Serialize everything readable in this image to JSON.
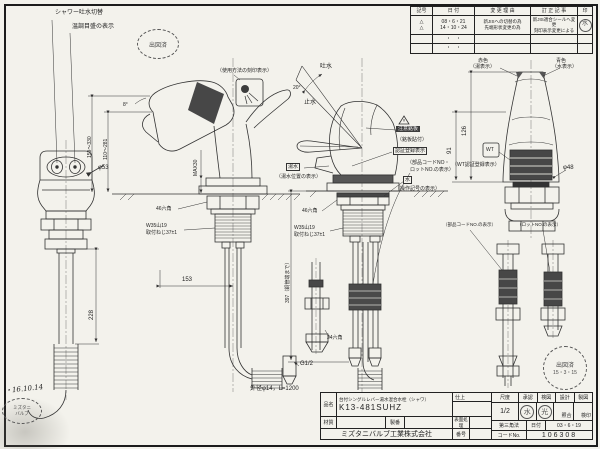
{
  "frame": {
    "paper": "#f3f2ec",
    "line": "#2b2b2b",
    "dark_fill": "#474747"
  },
  "revision": {
    "headers": [
      "記号",
      "日 付",
      "変 更 理 由",
      "訂 正 記 事",
      "印"
    ],
    "row1": {
      "sym1": "△",
      "sym2": "△",
      "date1": "08・6・21",
      "date2": "14・10・24",
      "reason1": "新JISへの切替の為",
      "reason2": "先端形状変更の為",
      "corr1": "新JIS適合シールへ変更",
      "corr2": "刻印表示変更による",
      "stamp": "水"
    },
    "row2_dots": "・　・",
    "row3_dots": "・　・"
  },
  "title_block": {
    "item_label": "品名",
    "item_name": "台付シングルレバー湯水混合水栓（シャワ）",
    "part_no": "K13-481SUHZ",
    "material_label": "材質",
    "material": "",
    "seiban_label": "製番",
    "seiban": "",
    "finish_label": "仕上",
    "finish": "",
    "surface_label": "表面処理",
    "surface": "",
    "bango_label": "番号",
    "bango": "",
    "company": "ミズタニバルブ工業株式会社",
    "scale_label": "尺度",
    "scale": "1/2",
    "approve_headers": [
      "承認",
      "検図",
      "設計",
      "製図"
    ],
    "stamp1": "水",
    "stamp2": "光",
    "sign3": "照合",
    "sign4": "検印",
    "projection": "第三角法",
    "date_label": "日付",
    "date": "03・6・19",
    "code_label": "コードNo.",
    "code": "106308"
  },
  "labels": {
    "shower_switch": "シャワー吐水切替",
    "temp_display": "温調目盛の表示",
    "usage_mark": "（使用方法の刻印表示）",
    "open": "吐水",
    "close": "止水",
    "caution": "注意銘板",
    "plate_paste": "（銘板貼付）",
    "cert_box": "認証登録表示",
    "parts_code": "（部品コードNO・",
    "lot_no": "ロットNO.の表示）",
    "yusui_box": "湯水",
    "yusui_label": "（湯水位置の表示）",
    "water_box": "水",
    "op_symbol": "（操作記号の表示）",
    "red1": "赤色",
    "red2": "（湯表示）",
    "blue1": "青色",
    "blue2": "（水表示）",
    "wt_box": "WT",
    "wt_label": "（WT認証登録表示）",
    "pipe_left": "（部品コードNO.の表示）",
    "pipe_right": "（ロットNO.の表示）",
    "hose_note": "外径φ14，L=1200",
    "g12": "G1/2"
  },
  "dims": {
    "d53": "φ53",
    "d228": "228",
    "d159": "159〜330",
    "d110": "110〜281",
    "max30": "MAX30",
    "hex46": "46六角",
    "w35": "W35山19",
    "screw37": "取付ねじ37±1",
    "d153": "153",
    "d397": "397（銅管端まで）",
    "hex24": "24六角",
    "d126": "126",
    "d91": "91",
    "d48": "φ48",
    "angle20": "20°",
    "angle8": "8°"
  },
  "stamps": {
    "top": "出図済",
    "bottom_right_1": "出図済",
    "bottom_right_2": "15・3・15",
    "note": "・16.10.14",
    "oval1": "ミズタニ",
    "oval2": "バルブ"
  }
}
